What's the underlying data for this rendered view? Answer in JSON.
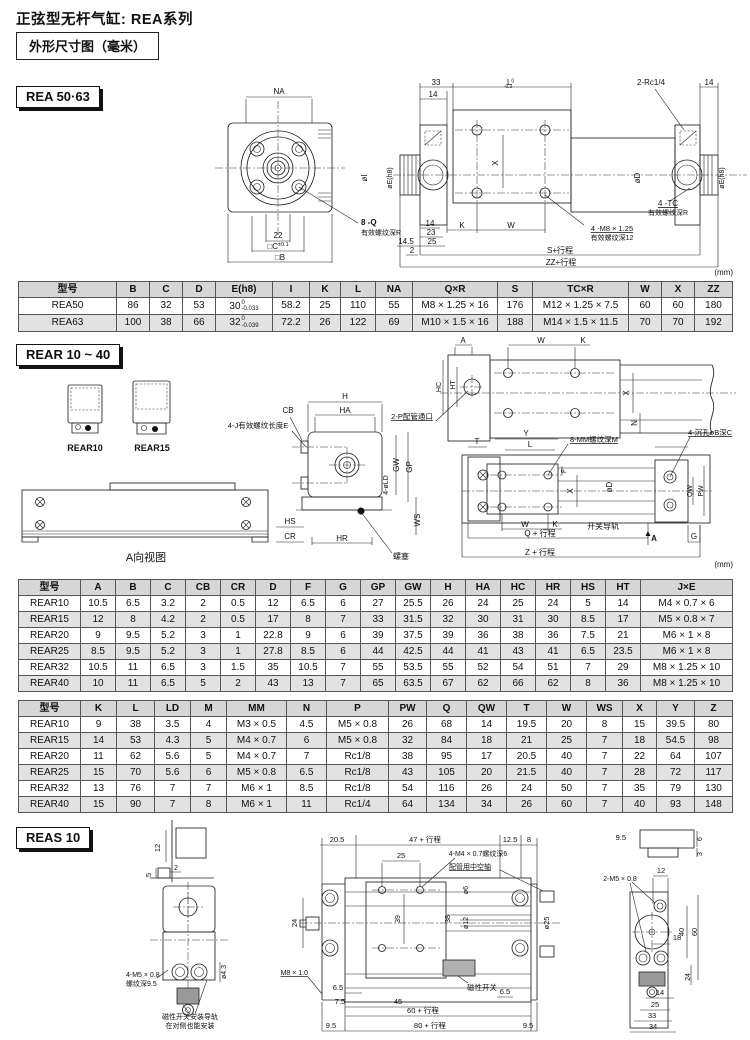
{
  "page": {
    "title": "正弦型无杆气缸: REA系列",
    "subtitle": "外形尺寸图（毫米）",
    "unit": "(mm)"
  },
  "sections": {
    "rea": {
      "heading": "REA 50·63"
    },
    "rear": {
      "heading": "REAR 10 ~ 40"
    },
    "reas": {
      "heading": "REAS 10"
    }
  },
  "tables": {
    "rea": {
      "headers": [
        "型号",
        "B",
        "C",
        "D",
        "E(h8)",
        "I",
        "K",
        "L",
        "NA",
        "Q×R",
        "S",
        "TC×R",
        "W",
        "X",
        "ZZ"
      ],
      "rows": [
        [
          "REA50",
          "86",
          "32",
          "53",
          "30|0|-0.033",
          "58.2",
          "25",
          "110",
          "55",
          "M8 × 1.25 × 16",
          "176",
          "M12 × 1.25 × 7.5",
          "60",
          "60",
          "180"
        ],
        [
          "REA63",
          "100",
          "38",
          "66",
          "32|0|-0.039",
          "72.2",
          "26",
          "122",
          "69",
          "M10 × 1.5 × 16",
          "188",
          "M14 × 1.5 × 11.5",
          "70",
          "70",
          "192"
        ]
      ]
    },
    "rear_dims1": {
      "headers": [
        "型号",
        "A",
        "B",
        "C",
        "CB",
        "CR",
        "D",
        "F",
        "G",
        "GP",
        "GW",
        "H",
        "HA",
        "HC",
        "HR",
        "HS",
        "HT",
        "J×E"
      ],
      "rows": [
        [
          "REAR10",
          "10.5",
          "6.5",
          "3.2",
          "2",
          "0.5",
          "12",
          "6.5",
          "6",
          "27",
          "25.5",
          "26",
          "24",
          "25",
          "24",
          "5",
          "14",
          "M4 × 0.7 × 6"
        ],
        [
          "REAR15",
          "12",
          "8",
          "4.2",
          "2",
          "0.5",
          "17",
          "8",
          "7",
          "33",
          "31.5",
          "32",
          "30",
          "31",
          "30",
          "8.5",
          "17",
          "M5 × 0.8 × 7"
        ],
        [
          "REAR20",
          "9",
          "9.5",
          "5.2",
          "3",
          "1",
          "22.8",
          "9",
          "6",
          "39",
          "37.5",
          "39",
          "36",
          "38",
          "36",
          "7.5",
          "21",
          "M6 × 1 × 8"
        ],
        [
          "REAR25",
          "8.5",
          "9.5",
          "5.2",
          "3",
          "1",
          "27.8",
          "8.5",
          "6",
          "44",
          "42.5",
          "44",
          "41",
          "43",
          "41",
          "6.5",
          "23.5",
          "M6 × 1 × 8"
        ],
        [
          "REAR32",
          "10.5",
          "11",
          "6.5",
          "3",
          "1.5",
          "35",
          "10.5",
          "7",
          "55",
          "53.5",
          "55",
          "52",
          "54",
          "51",
          "7",
          "29",
          "M8 × 1.25 × 10"
        ],
        [
          "REAR40",
          "10",
          "11",
          "6.5",
          "5",
          "2",
          "43",
          "13",
          "7",
          "65",
          "63.5",
          "67",
          "62",
          "66",
          "62",
          "8",
          "36",
          "M8 × 1.25 × 10"
        ]
      ]
    },
    "rear_dims2": {
      "headers": [
        "型号",
        "K",
        "L",
        "LD",
        "M",
        "MM",
        "N",
        "P",
        "PW",
        "Q",
        "QW",
        "T",
        "W",
        "WS",
        "X",
        "Y",
        "Z"
      ],
      "rows": [
        [
          "REAR10",
          "9",
          "38",
          "3.5",
          "4",
          "M3 × 0.5",
          "4.5",
          "M5 × 0.8",
          "26",
          "68",
          "14",
          "19.5",
          "20",
          "8",
          "15",
          "39.5",
          "80"
        ],
        [
          "REAR15",
          "14",
          "53",
          "4.3",
          "5",
          "M4 × 0.7",
          "6",
          "M5 × 0.8",
          "32",
          "84",
          "18",
          "21",
          "25",
          "7",
          "18",
          "54.5",
          "98"
        ],
        [
          "REAR20",
          "11",
          "62",
          "5.6",
          "5",
          "M4 × 0.7",
          "7",
          "Rc1/8",
          "38",
          "95",
          "17",
          "20.5",
          "40",
          "7",
          "22",
          "64",
          "107"
        ],
        [
          "REAR25",
          "15",
          "70",
          "5.6",
          "6",
          "M5 × 0.8",
          "6.5",
          "Rc1/8",
          "43",
          "105",
          "20",
          "21.5",
          "40",
          "7",
          "28",
          "72",
          "117"
        ],
        [
          "REAR32",
          "13",
          "76",
          "7",
          "7",
          "M6 × 1",
          "8.5",
          "Rc1/8",
          "54",
          "116",
          "26",
          "24",
          "50",
          "7",
          "35",
          "79",
          "130"
        ],
        [
          "REAR40",
          "15",
          "90",
          "7",
          "8",
          "M6 × 1",
          "11",
          "Rc1/4",
          "64",
          "134",
          "34",
          "26",
          "60",
          "7",
          "40",
          "93",
          "148"
        ]
      ]
    }
  },
  "drawings": {
    "rea": {
      "labels": [
        {
          "t": "NA",
          "x": 279,
          "y": 19
        },
        {
          "t": "22",
          "x": 278,
          "y": 163
        },
        {
          "t": "□C",
          "sup": "±0.1",
          "x": 278,
          "y": 174
        },
        {
          "t": "□B",
          "x": 280,
          "y": 185
        },
        {
          "t": "8 -Q",
          "x": 361,
          "y": 150,
          "a": "start",
          "b": 1
        },
        {
          "t": "有效螺纹深R",
          "x": 361,
          "y": 160,
          "a": "start",
          "s": 7
        },
        {
          "t": "33",
          "x": 436,
          "y": 10
        },
        {
          "t": "14",
          "x": 433,
          "y": 22
        },
        {
          "t": "L",
          "tt": "0",
          "tb": "-0.2",
          "x": 509,
          "y": 10
        },
        {
          "t": "2-Rc1/4",
          "x": 637,
          "y": 10,
          "a": "start"
        },
        {
          "t": "14",
          "x": 709,
          "y": 10
        },
        {
          "t": "øI",
          "x": 367,
          "y": 103,
          "r": -90
        },
        {
          "t": "øE(h8)",
          "x": 392,
          "y": 103,
          "r": -90,
          "s": 7
        },
        {
          "t": "X",
          "x": 498,
          "y": 88,
          "r": -90
        },
        {
          "t": "øD",
          "x": 640,
          "y": 103,
          "r": -90
        },
        {
          "t": "øE(h8)",
          "x": 724,
          "y": 103,
          "r": -90,
          "s": 7
        },
        {
          "t": "14",
          "x": 430,
          "y": 151
        },
        {
          "t": "23",
          "x": 431,
          "y": 160
        },
        {
          "t": "25",
          "x": 432,
          "y": 169
        },
        {
          "t": "14.5",
          "x": 406,
          "y": 169
        },
        {
          "t": "2",
          "x": 412,
          "y": 178
        },
        {
          "t": "K",
          "x": 462,
          "y": 153
        },
        {
          "t": "W",
          "x": 511,
          "y": 153
        },
        {
          "t": "4 -M8 × 1.25",
          "x": 612,
          "y": 156,
          "s": 7.5,
          "u": 1
        },
        {
          "t": "有效螺纹深12",
          "x": 612,
          "y": 165,
          "s": 7
        },
        {
          "t": "4 -TC",
          "x": 668,
          "y": 131,
          "u": 1
        },
        {
          "t": "有效螺纹深R",
          "x": 668,
          "y": 140,
          "s": 7
        },
        {
          "t": "S+行程",
          "x": 560,
          "y": 178
        },
        {
          "t": "ZZ+行程",
          "x": 561,
          "y": 190
        },
        {
          "t": "(mm)",
          "x": 733,
          "y": 200,
          "a": "end"
        }
      ]
    },
    "rear": {
      "labels": [
        {
          "t": "REAR10",
          "x": 85,
          "y": 116,
          "s": 9,
          "b": 1
        },
        {
          "t": "REAR15",
          "x": 152,
          "y": 116,
          "s": 9,
          "b": 1
        },
        {
          "t": "A向视图",
          "x": 146,
          "y": 226,
          "s": 11
        },
        {
          "t": "CB",
          "x": 288,
          "y": 78
        },
        {
          "t": "4-J有效螺纹长度E",
          "x": 258,
          "y": 93,
          "s": 7.5
        },
        {
          "t": "HS",
          "x": 290,
          "y": 189
        },
        {
          "t": "CR",
          "x": 290,
          "y": 204
        },
        {
          "t": "H",
          "x": 345,
          "y": 64
        },
        {
          "t": "HA",
          "x": 345,
          "y": 78
        },
        {
          "t": "GW",
          "x": 399,
          "y": 130,
          "r": -90
        },
        {
          "t": "GP",
          "x": 412,
          "y": 132,
          "r": -90
        },
        {
          "t": "4-øLD",
          "x": 388,
          "y": 150,
          "r": -90,
          "s": 7
        },
        {
          "t": "WS",
          "x": 420,
          "y": 185,
          "r": -90
        },
        {
          "t": "HR",
          "x": 342,
          "y": 206
        },
        {
          "t": "螺塞",
          "x": 401,
          "y": 224,
          "s": 8
        },
        {
          "t": "2-P配管通口",
          "x": 412,
          "y": 84,
          "s": 7.5,
          "u": 1
        },
        {
          "t": "A",
          "x": 463,
          "y": 8
        },
        {
          "t": "W",
          "x": 541,
          "y": 8
        },
        {
          "t": "K",
          "x": 583,
          "y": 8
        },
        {
          "t": "HC",
          "x": 441,
          "y": 52,
          "r": -90,
          "s": 7
        },
        {
          "t": "HT",
          "x": 455,
          "y": 50,
          "r": -90,
          "s": 7
        },
        {
          "t": "X",
          "x": 629,
          "y": 58,
          "r": -90
        },
        {
          "t": "N",
          "x": 637,
          "y": 88,
          "r": -90
        },
        {
          "t": "T",
          "x": 477,
          "y": 109
        },
        {
          "t": "Y",
          "x": 526,
          "y": 101
        },
        {
          "t": "L",
          "x": 530,
          "y": 112
        },
        {
          "t": "8-MM螺纹深M",
          "x": 570,
          "y": 107,
          "a": "start",
          "s": 7.5,
          "u": 1
        },
        {
          "t": "4-沉孔øB深C",
          "x": 688,
          "y": 100,
          "a": "start",
          "s": 7.5,
          "u": 1
        },
        {
          "t": "F",
          "x": 566,
          "y": 136,
          "r": -90,
          "s": 7
        },
        {
          "t": "X",
          "x": 573,
          "y": 156,
          "r": -90
        },
        {
          "t": "øD",
          "x": 612,
          "y": 152,
          "r": -90
        },
        {
          "t": "QW",
          "x": 692,
          "y": 156,
          "r": -90,
          "s": 7
        },
        {
          "t": "PW",
          "x": 703,
          "y": 156,
          "r": -90,
          "s": 7
        },
        {
          "t": "W",
          "x": 525,
          "y": 192
        },
        {
          "t": "K",
          "x": 555,
          "y": 192
        },
        {
          "t": "开关导轨",
          "x": 587,
          "y": 194,
          "a": "start",
          "s": 8
        },
        {
          "t": "Q + 行程",
          "x": 540,
          "y": 201
        },
        {
          "t": "A",
          "x": 654,
          "y": 206,
          "b": 1
        },
        {
          "t": "G",
          "x": 694,
          "y": 204
        },
        {
          "t": "Z + 行程",
          "x": 540,
          "y": 220
        },
        {
          "t": "(mm)",
          "x": 733,
          "y": 232,
          "a": "end"
        }
      ]
    },
    "reas": {
      "labels": [
        {
          "t": "12",
          "x": 160,
          "y": 28,
          "r": -90,
          "s": 7.5
        },
        {
          "t": "5",
          "x": 151,
          "y": 55,
          "r": -90,
          "s": 7.5
        },
        {
          "t": "2",
          "x": 176,
          "y": 50,
          "s": 7
        },
        {
          "t": "4-M5 × 0.8",
          "x": 126,
          "y": 157,
          "a": "start",
          "s": 7
        },
        {
          "t": "螺纹深9.5",
          "x": 126,
          "y": 166,
          "a": "start",
          "s": 7
        },
        {
          "t": "ø4.3",
          "x": 226,
          "y": 152,
          "r": -90,
          "s": 7
        },
        {
          "t": "磁性开关安装导轨",
          "x": 190,
          "y": 199,
          "s": 7
        },
        {
          "t": "在对侧也能安装",
          "x": 190,
          "y": 208,
          "s": 7
        },
        {
          "t": "20.5",
          "x": 337,
          "y": 22,
          "s": 7.5
        },
        {
          "t": "47 + 行程",
          "x": 425,
          "y": 22,
          "s": 7.5
        },
        {
          "t": "12.5",
          "x": 510,
          "y": 22,
          "s": 7.5
        },
        {
          "t": "8",
          "x": 529,
          "y": 22,
          "s": 7.5
        },
        {
          "t": "25",
          "x": 401,
          "y": 38,
          "s": 7.5
        },
        {
          "t": "4-M4 × 0.7螺纹深6",
          "x": 478,
          "y": 36,
          "s": 7
        },
        {
          "t": "配管用中空轴",
          "x": 470,
          "y": 49,
          "s": 7,
          "u": 1
        },
        {
          "t": "M8 × 1.0",
          "x": 308,
          "y": 155,
          "a": "end",
          "s": 7,
          "u": 1
        },
        {
          "t": "24",
          "x": 297,
          "y": 103,
          "r": -90,
          "s": 7.5
        },
        {
          "t": "39",
          "x": 400,
          "y": 99,
          "r": -90,
          "s": 7
        },
        {
          "t": "38",
          "x": 450,
          "y": 99,
          "r": -90,
          "s": 7
        },
        {
          "t": "ø6",
          "x": 468,
          "y": 70,
          "r": -90,
          "s": 7
        },
        {
          "t": "ø12",
          "x": 468,
          "y": 103,
          "r": -90,
          "s": 7
        },
        {
          "t": "ø25",
          "x": 549,
          "y": 103,
          "r": -90,
          "s": 7.5
        },
        {
          "t": "磁性开关",
          "x": 482,
          "y": 170,
          "s": 7.5
        },
        {
          "t": "6.5",
          "x": 338,
          "y": 170,
          "s": 7.5
        },
        {
          "t": "7.5",
          "x": 340,
          "y": 184,
          "s": 7.5
        },
        {
          "t": "45",
          "x": 398,
          "y": 184,
          "s": 7.5
        },
        {
          "t": "6.5",
          "x": 505,
          "y": 174,
          "s": 7.5
        },
        {
          "t": "60 + 行程",
          "x": 423,
          "y": 193,
          "s": 7.5
        },
        {
          "t": "9.5",
          "x": 331,
          "y": 208,
          "s": 7.5
        },
        {
          "t": "80 + 行程",
          "x": 430,
          "y": 208,
          "s": 7.5
        },
        {
          "t": "9.5",
          "x": 528,
          "y": 208,
          "s": 7.5
        },
        {
          "t": "9.5",
          "x": 626,
          "y": 20,
          "a": "end",
          "s": 7.5
        },
        {
          "t": "6",
          "x": 702,
          "y": 19,
          "r": -90,
          "s": 7
        },
        {
          "t": "3",
          "x": 702,
          "y": 34,
          "r": -90,
          "s": 7
        },
        {
          "t": "12",
          "x": 661,
          "y": 53,
          "s": 7.5
        },
        {
          "t": "2-M5 × 0.8",
          "x": 620,
          "y": 61,
          "s": 7
        },
        {
          "t": "18",
          "x": 677,
          "y": 120,
          "s": 7.5
        },
        {
          "t": "40",
          "x": 684,
          "y": 112,
          "r": -90,
          "s": 7.5
        },
        {
          "t": "60",
          "x": 697,
          "y": 112,
          "r": -90,
          "s": 7.5
        },
        {
          "t": "24",
          "x": 690,
          "y": 157,
          "r": -90,
          "s": 7
        },
        {
          "t": "14",
          "x": 660,
          "y": 175,
          "s": 7.5
        },
        {
          "t": "25",
          "x": 655,
          "y": 187,
          "s": 7.5
        },
        {
          "t": "33",
          "x": 652,
          "y": 198,
          "s": 7.5
        },
        {
          "t": "34",
          "x": 653,
          "y": 209,
          "s": 7.5
        }
      ]
    }
  }
}
